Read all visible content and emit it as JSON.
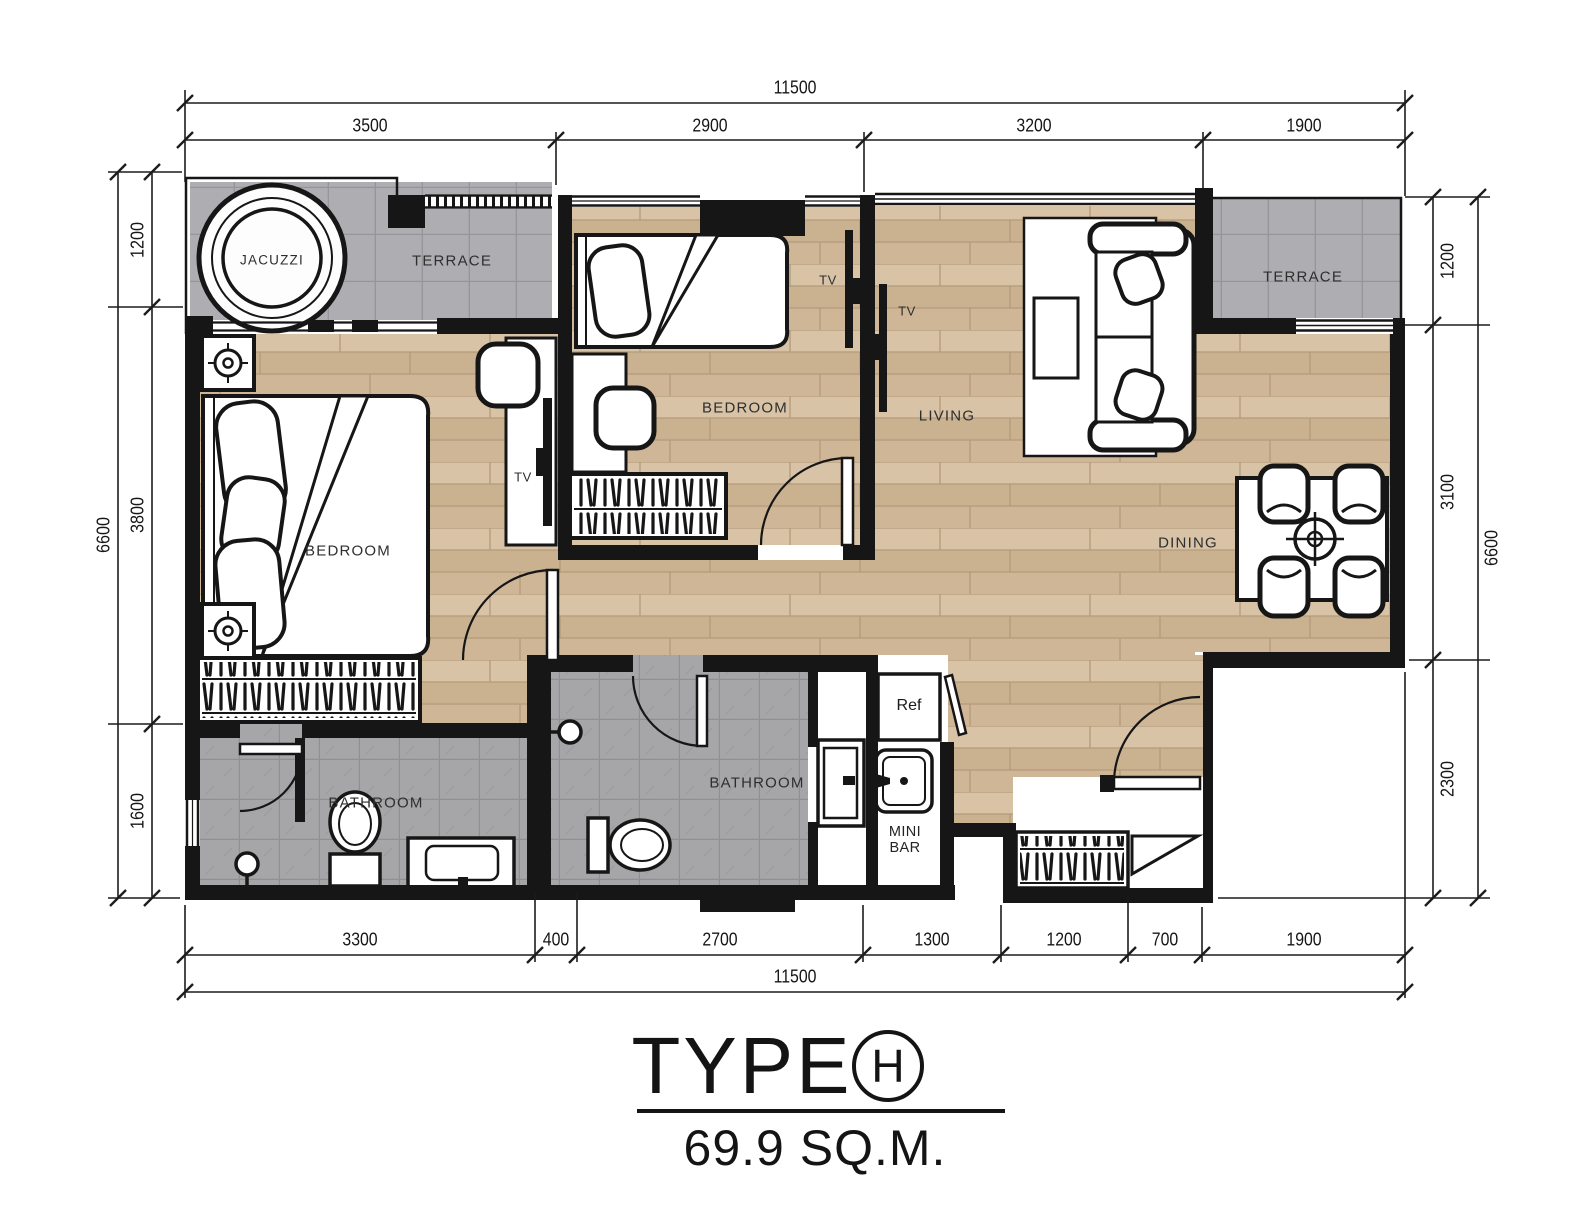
{
  "title": {
    "name": "TYPE",
    "variant": "H",
    "area": "69.9 SQ.M."
  },
  "dimensions": {
    "top": {
      "total": "11500",
      "segments": [
        "3500",
        "2900",
        "3200",
        "1900"
      ]
    },
    "bottom": {
      "total": "11500",
      "segments": [
        "3300",
        "400",
        "2700",
        "1300",
        "1200",
        "700",
        "1900"
      ]
    },
    "left": {
      "total": "6600",
      "segments": [
        "1200",
        "3800",
        "1600"
      ]
    },
    "right": {
      "total": "6600",
      "segments": [
        "1200",
        "3100",
        "2300"
      ]
    }
  },
  "rooms": {
    "jacuzzi": "JACUZZI",
    "terrace_left": "TERRACE",
    "terrace_right": "TERRACE",
    "bedroom_master": "BEDROOM",
    "bedroom_second": "BEDROOM",
    "living": "LIVING",
    "dining": "DINING",
    "bathroom_master": "BATHROOM",
    "bathroom_shared": "BATHROOM",
    "tv_master": "TV",
    "tv_bedroom": "TV",
    "tv_living": "TV",
    "refrigerator": "Ref",
    "minibar": "MINI\nBAR"
  },
  "colors": {
    "wall": "#161616",
    "wood_floor": "#d2bc9e",
    "terrace_tile": "#aeaeb2",
    "bath_tile": "#a6a6a8"
  }
}
